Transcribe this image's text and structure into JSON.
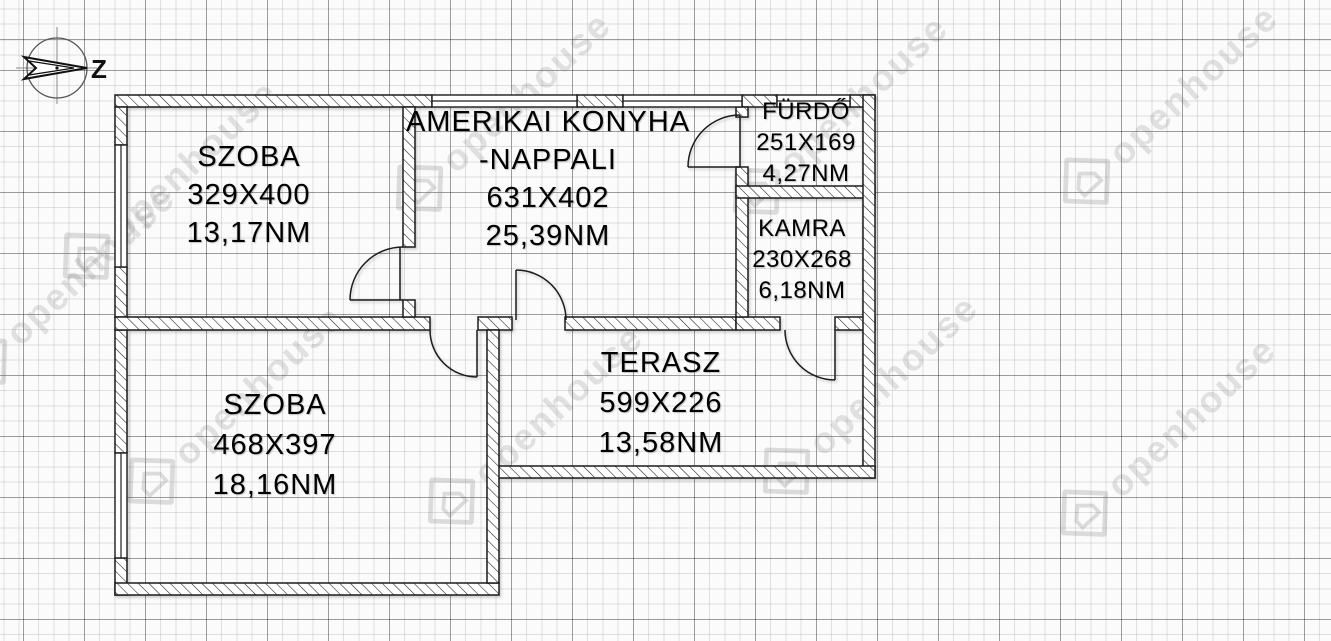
{
  "compass": {
    "label": "Z"
  },
  "watermark": {
    "text": "openhouse"
  },
  "rooms": [
    {
      "id": "szoba-1",
      "name": "SZOBA",
      "dimensions": "329X400",
      "area": "13,17NM"
    },
    {
      "id": "amerikai-konyha-nappali",
      "name": "AMERIKAI KONYHA",
      "name2": "-NAPPALI",
      "dimensions": "631X402",
      "area": "25,39NM"
    },
    {
      "id": "furdo",
      "name": "FÜRDŐ",
      "dimensions": "251X169",
      "area": "4,27NM"
    },
    {
      "id": "kamra",
      "name": "KAMRA",
      "dimensions": "230X268",
      "area": "6,18NM"
    },
    {
      "id": "szoba-2",
      "name": "SZOBA",
      "dimensions": "468X397",
      "area": "18,16NM"
    },
    {
      "id": "terasz",
      "name": "TERASZ",
      "dimensions": "599X226",
      "area": "13,58NM"
    }
  ],
  "colors": {
    "wall_line": "#1a1a1a",
    "grid_minor": "#dddddd",
    "grid_major": "#b2b2b2",
    "watermark": "#808080"
  }
}
